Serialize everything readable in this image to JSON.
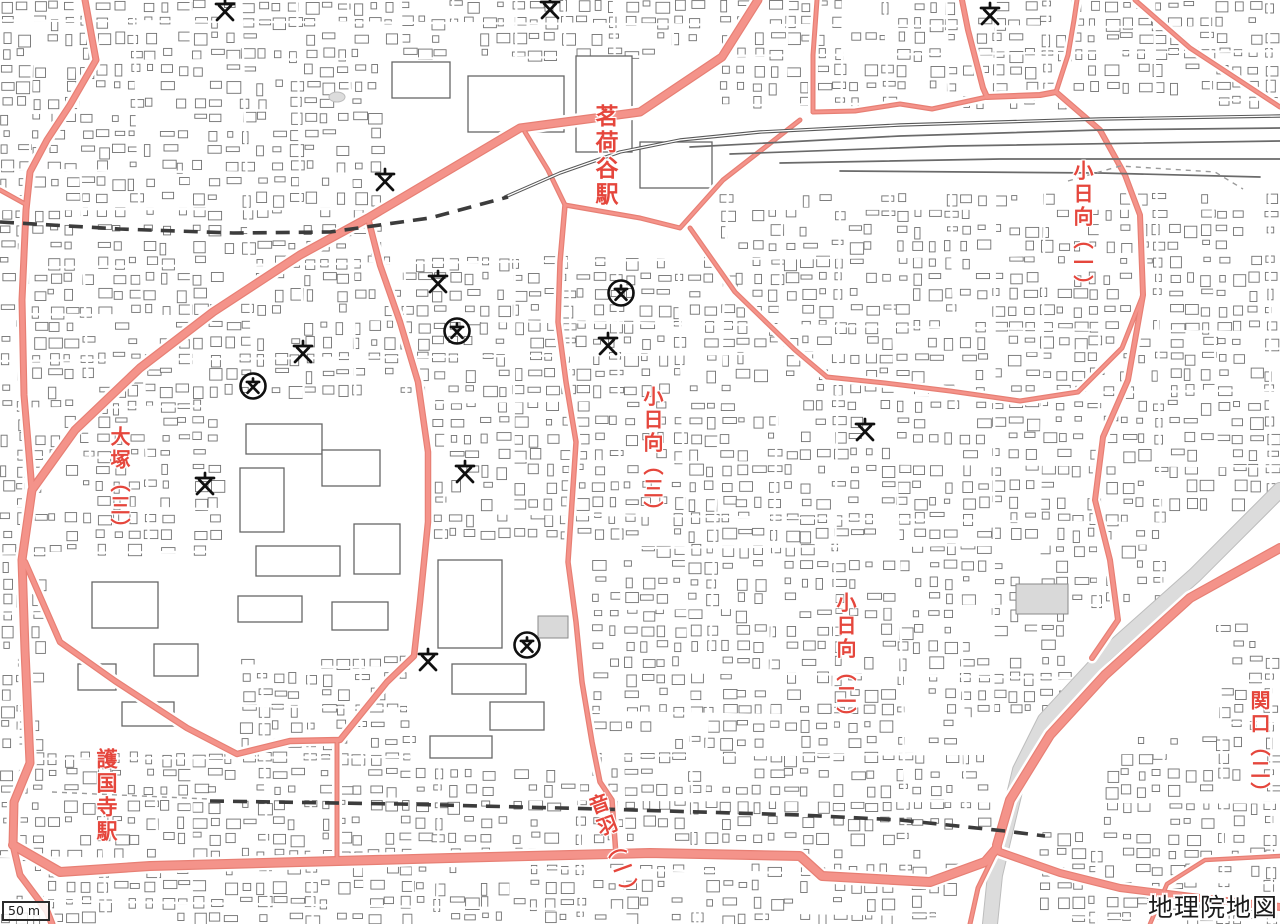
{
  "app": {
    "attribution": "地理院地図",
    "scale_bar": {
      "label": "50 m"
    }
  },
  "map": {
    "width": 1280,
    "height": 924,
    "colors": {
      "background": "#ffffff",
      "building_outline": "#717171",
      "road_fill": "#F4938A",
      "road_edge": "#E77F74",
      "road_casing": "#ffffff",
      "railway": "#585858",
      "subway_dashed": "#3c3c3c",
      "boundary_dashed": "#9a9a9a",
      "river": "#dcdcdc",
      "river_edge": "#bdbdbd",
      "label_red": "#E5463C",
      "symbol_black": "#101010"
    },
    "labels": [
      {
        "id": "myogadani-station",
        "text": "茗荷谷駅",
        "x": 592,
        "y": 104,
        "size": 23,
        "rotate": 0
      },
      {
        "id": "kohinata-1",
        "text": "小日向（一）",
        "x": 1072,
        "y": 160,
        "size": 20,
        "rotate": 0
      },
      {
        "id": "kohinata-3",
        "text": "小日向（三）",
        "x": 642,
        "y": 386,
        "size": 20,
        "rotate": 0
      },
      {
        "id": "kohinata-2",
        "text": "小日向（二）",
        "x": 835,
        "y": 592,
        "size": 20,
        "rotate": 0
      },
      {
        "id": "otsuka-3",
        "text": "大塚（三）",
        "x": 109,
        "y": 426,
        "size": 20,
        "rotate": 0
      },
      {
        "id": "gokokuji-station",
        "text": "護国寺駅",
        "x": 95,
        "y": 748,
        "size": 21,
        "rotate": 0
      },
      {
        "id": "sekiguchi-2",
        "text": "関口（二）",
        "x": 1249,
        "y": 690,
        "size": 20,
        "rotate": 0
      },
      {
        "id": "otowa-1",
        "text": "音羽（一）",
        "x": 585,
        "y": 798,
        "size": 20,
        "rotate": -20
      }
    ],
    "symbols": {
      "school": [
        [
          225,
          10
        ],
        [
          550,
          8
        ],
        [
          990,
          14
        ],
        [
          385,
          180
        ],
        [
          438,
          282
        ],
        [
          303,
          352
        ],
        [
          608,
          344
        ],
        [
          205,
          484
        ],
        [
          465,
          472
        ],
        [
          865,
          430
        ],
        [
          428,
          660
        ]
      ],
      "high_school": [
        [
          621,
          293
        ],
        [
          457,
          331
        ],
        [
          253,
          386
        ],
        [
          527,
          645
        ]
      ]
    },
    "roads": {
      "major": [
        {
          "w": 9,
          "pts": [
            [
              758,
              0
            ],
            [
              722,
              57
            ],
            [
              640,
              112
            ],
            [
              520,
              128
            ],
            [
              368,
              218
            ],
            [
              300,
              255
            ],
            [
              213,
              312
            ],
            [
              140,
              368
            ],
            [
              75,
              430
            ],
            [
              32,
              490
            ],
            [
              22,
              560
            ],
            [
              25,
              650
            ],
            [
              30,
              763
            ],
            [
              14,
              802
            ],
            [
              13,
              845
            ]
          ]
        },
        {
          "w": 7,
          "pts": [
            [
              85,
              0
            ],
            [
              96,
              60
            ],
            [
              70,
              105
            ],
            [
              47,
              140
            ],
            [
              30,
              172
            ],
            [
              26,
              210
            ],
            [
              22,
              300
            ],
            [
              24,
              395
            ],
            [
              32,
              490
            ]
          ]
        },
        {
          "w": 10,
          "pts": [
            [
              13,
              845
            ],
            [
              60,
              872
            ],
            [
              150,
              866
            ],
            [
              300,
              862
            ],
            [
              450,
              858
            ],
            [
              650,
              853
            ],
            [
              800,
              856
            ],
            [
              822,
              876
            ],
            [
              930,
              882
            ],
            [
              985,
              862
            ],
            [
              997,
              848
            ]
          ]
        },
        {
          "w": 10,
          "pts": [
            [
              997,
              845
            ],
            [
              1010,
              800
            ],
            [
              1050,
              735
            ],
            [
              1105,
              675
            ],
            [
              1190,
              598
            ],
            [
              1280,
              548
            ]
          ]
        },
        {
          "w": 8,
          "pts": [
            [
              1000,
              852
            ],
            [
              1060,
              873
            ],
            [
              1120,
              888
            ],
            [
              1200,
              898
            ],
            [
              1280,
              907
            ]
          ]
        },
        {
          "w": 6.5,
          "pts": [
            [
              368,
              218
            ],
            [
              380,
              265
            ],
            [
              400,
              322
            ],
            [
              418,
              382
            ],
            [
              428,
              452
            ],
            [
              428,
              522
            ],
            [
              420,
              602
            ],
            [
              414,
              656
            ],
            [
              387,
              682
            ],
            [
              340,
              740
            ],
            [
              290,
              741
            ],
            [
              237,
              754
            ],
            [
              187,
              728
            ],
            [
              115,
              681
            ],
            [
              60,
              642
            ],
            [
              25,
              562
            ]
          ]
        },
        {
          "w": 7,
          "pts": [
            [
              13,
              845
            ],
            [
              20,
              875
            ],
            [
              47,
              911
            ],
            [
              52,
              924
            ]
          ]
        },
        {
          "w": 6,
          "pts": [
            [
              1056,
              92
            ],
            [
              1100,
              130
            ],
            [
              1125,
              175
            ],
            [
              1140,
              215
            ],
            [
              1143,
              295
            ],
            [
              1128,
              380
            ],
            [
              1103,
              437
            ],
            [
              1095,
              500
            ],
            [
              1110,
              560
            ],
            [
              1118,
              620
            ],
            [
              1092,
              658
            ]
          ]
        }
      ],
      "minor": [
        {
          "w": 5,
          "pts": [
            [
              565,
              205
            ],
            [
              640,
              218
            ],
            [
              680,
              228
            ],
            [
              723,
              180
            ],
            [
              800,
              120
            ]
          ]
        },
        {
          "w": 5,
          "pts": [
            [
              525,
              132
            ],
            [
              548,
              170
            ],
            [
              565,
              205
            ]
          ]
        },
        {
          "w": 5.5,
          "pts": [
            [
              565,
              205
            ],
            [
              560,
              262
            ],
            [
              558,
              322
            ],
            [
              566,
              382
            ],
            [
              576,
              442
            ],
            [
              572,
              502
            ],
            [
              568,
              562
            ],
            [
              576,
              622
            ],
            [
              582,
              682
            ],
            [
              592,
              742
            ],
            [
              600,
              782
            ],
            [
              612,
              800
            ],
            [
              616,
              855
            ]
          ]
        },
        {
          "w": 5,
          "pts": [
            [
              690,
              228
            ],
            [
              735,
              292
            ],
            [
              795,
              350
            ],
            [
              827,
              377
            ]
          ]
        },
        {
          "w": 5,
          "pts": [
            [
              827,
              377
            ],
            [
              885,
              383
            ],
            [
              950,
              391
            ],
            [
              1020,
              401
            ],
            [
              1078,
              392
            ],
            [
              1122,
              348
            ],
            [
              1143,
              295
            ]
          ]
        },
        {
          "w": 5,
          "pts": [
            [
              817,
              0
            ],
            [
              813,
              55
            ],
            [
              813,
              112
            ]
          ]
        },
        {
          "w": 5,
          "pts": [
            [
              813,
              112
            ],
            [
              855,
              111
            ],
            [
              900,
              104
            ],
            [
              932,
              109
            ],
            [
              987,
              97
            ]
          ]
        },
        {
          "w": 6,
          "pts": [
            [
              962,
              0
            ],
            [
              968,
              30
            ],
            [
              983,
              88
            ],
            [
              987,
              97
            ]
          ]
        },
        {
          "w": 6,
          "pts": [
            [
              987,
              97
            ],
            [
              1040,
              95
            ],
            [
              1056,
              92
            ]
          ]
        },
        {
          "w": 5,
          "pts": [
            [
              1056,
              92
            ],
            [
              1068,
              55
            ],
            [
              1074,
              20
            ],
            [
              1077,
              0
            ]
          ]
        },
        {
          "w": 5,
          "pts": [
            [
              1135,
              0
            ],
            [
              1190,
              48
            ],
            [
              1280,
              107
            ]
          ]
        },
        {
          "w": 5,
          "pts": [
            [
              337,
              740
            ],
            [
              337,
              800
            ],
            [
              337,
              862
            ]
          ]
        },
        {
          "w": 5,
          "pts": [
            [
              0,
              190
            ],
            [
              27,
              205
            ]
          ]
        },
        {
          "w": 4.5,
          "pts": [
            [
              1150,
              924
            ],
            [
              1167,
              884
            ],
            [
              1205,
              860
            ],
            [
              1280,
              856
            ]
          ]
        },
        {
          "w": 5,
          "pts": [
            [
              997,
              849
            ],
            [
              978,
              888
            ],
            [
              970,
              924
            ]
          ]
        }
      ]
    },
    "railways": {
      "main": [
        [
          505,
          197
        ],
        [
          560,
          173
        ],
        [
          620,
          152
        ],
        [
          680,
          140
        ],
        [
          760,
          132
        ],
        [
          900,
          125
        ],
        [
          1100,
          119
        ],
        [
          1280,
          116
        ]
      ],
      "yard": [
        [
          [
            690,
            147
          ],
          [
            900,
            136
          ],
          [
            1100,
            130
          ],
          [
            1280,
            128
          ]
        ],
        [
          [
            730,
            154
          ],
          [
            950,
            146
          ],
          [
            1280,
            141
          ]
        ],
        [
          [
            780,
            163
          ],
          [
            1000,
            159
          ],
          [
            1280,
            159
          ]
        ],
        [
          [
            840,
            171
          ],
          [
            1100,
            173
          ],
          [
            1260,
            177
          ]
        ]
      ]
    },
    "dashed": [
      {
        "style": "bold",
        "pts": [
          [
            0,
            222
          ],
          [
            120,
            229
          ],
          [
            233,
            233
          ],
          [
            330,
            232
          ],
          [
            430,
            218
          ],
          [
            508,
            197
          ]
        ]
      },
      {
        "style": "bold",
        "pts": [
          [
            210,
            801
          ],
          [
            400,
            804
          ],
          [
            600,
            809
          ],
          [
            800,
            815
          ],
          [
            900,
            820
          ],
          [
            1005,
            831
          ],
          [
            1045,
            836
          ]
        ]
      },
      {
        "style": "thin",
        "pts": [
          [
            52,
            792
          ],
          [
            208,
            799
          ]
        ]
      },
      {
        "style": "thin",
        "pts": [
          [
            1068,
            181
          ],
          [
            1120,
            166
          ],
          [
            1215,
            172
          ],
          [
            1243,
            189
          ]
        ]
      }
    ],
    "river": {
      "pts": [
        [
          1280,
          490
        ],
        [
          1195,
          575
        ],
        [
          1105,
          655
        ],
        [
          1045,
          720
        ],
        [
          1020,
          770
        ],
        [
          1008,
          820
        ],
        [
          995,
          875
        ],
        [
          990,
          924
        ]
      ],
      "w": 14
    },
    "pond": {
      "cx": 337,
      "cy": 97,
      "rx": 8,
      "ry": 5
    },
    "texture": {
      "seed": 11,
      "cell": 16,
      "density": 0.74,
      "clear": [
        [
          382,
          52,
          335,
          195
        ],
        [
          215,
          393,
          205,
          262
        ],
        [
          413,
          538,
          168,
          222
        ],
        [
          48,
          553,
          192,
          192
        ],
        [
          635,
          98,
          645,
          95
        ],
        [
          1160,
          500,
          120,
          115
        ],
        [
          1060,
          608,
          150,
          122
        ],
        [
          988,
          712,
          112,
          118
        ],
        [
          952,
          825,
          78,
          99
        ]
      ],
      "streets": {
        "v": 24,
        "h": 19
      }
    },
    "large_buildings": [
      [
        392,
        62,
        58,
        36
      ],
      [
        468,
        76,
        96,
        56
      ],
      [
        576,
        56,
        56,
        96
      ],
      [
        640,
        142,
        72,
        46
      ],
      [
        246,
        424,
        76,
        30
      ],
      [
        240,
        468,
        44,
        64
      ],
      [
        322,
        450,
        58,
        36
      ],
      [
        256,
        546,
        84,
        30
      ],
      [
        354,
        524,
        46,
        50
      ],
      [
        238,
        596,
        64,
        26
      ],
      [
        332,
        602,
        56,
        28
      ],
      [
        438,
        560,
        64,
        88
      ],
      [
        452,
        664,
        74,
        30
      ],
      [
        490,
        702,
        54,
        28
      ],
      [
        430,
        736,
        62,
        22
      ],
      [
        92,
        582,
        66,
        46
      ],
      [
        154,
        644,
        44,
        32
      ],
      [
        78,
        664,
        38,
        26
      ],
      [
        122,
        702,
        52,
        24
      ]
    ],
    "gray_buildings": [
      [
        538,
        616,
        30,
        22
      ],
      [
        1016,
        584,
        52,
        30
      ]
    ]
  }
}
